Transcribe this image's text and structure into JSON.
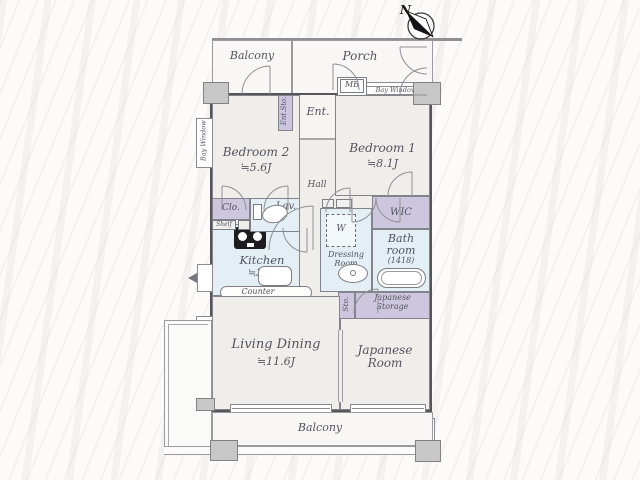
{
  "plan_title": "apartment-floor-plan",
  "colors": {
    "wall": "#58585c",
    "room_floor": "#f0eeea",
    "wet_area_floor": "#e3eff4",
    "storage_fill": "#ccc7df",
    "outdoor_floor": "#f8f7f5"
  },
  "compass": {
    "north": "N"
  },
  "outdoor": {
    "balcony_top": "Balcony",
    "porch": "Porch",
    "balcony_bottom": "Balcony",
    "meter_box": "MB",
    "bay_window_top": "Bay Window",
    "bay_window_bedroom2": "Bay Window",
    "bay_window_living": "Bay Window"
  },
  "rooms": {
    "entrance": {
      "label": "Ent."
    },
    "entrance_storage": {
      "label": "Ent.Sto."
    },
    "hall": {
      "label": "Hall"
    },
    "bedroom2": {
      "label": "Bedroom 2",
      "area": "≒5.6J"
    },
    "bedroom1": {
      "label": "Bedroom 1",
      "area": "≒8.1J"
    },
    "closet": {
      "label": "Clo."
    },
    "shelf": {
      "label": "Shelf"
    },
    "lavatory": {
      "label": "Lav."
    },
    "kitchen": {
      "label": "Kitchen",
      "area": "≒3.3J"
    },
    "counter": {
      "label": "Counter"
    },
    "wic": {
      "label": "WIC"
    },
    "bathroom": {
      "label": "Bath room",
      "size": "(1418)"
    },
    "dressing_room": {
      "label": "Dressing Room",
      "washer": "W"
    },
    "storage": {
      "label": "Sto."
    },
    "japanese_storage": {
      "label": "Japanese Storage"
    },
    "living_dining": {
      "label": "Living Dining",
      "area": "≒11.6J"
    },
    "japanese_room": {
      "label": "Japanese Room"
    }
  }
}
